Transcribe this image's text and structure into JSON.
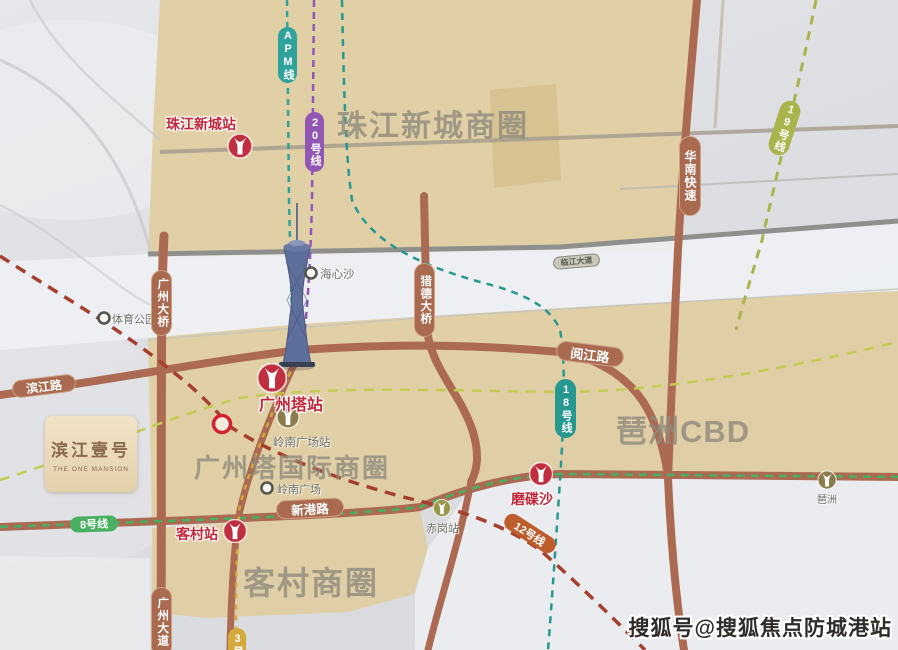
{
  "watermark": "搜狐号@搜狐焦点防城港站",
  "project": {
    "name_cn": "滨江壹号",
    "name_en": "THE ONE MANSION"
  },
  "districts": {
    "zhujiang_new_town": "珠江新城商圈",
    "canton_tower_intl": "广州塔国际商圈",
    "pazhou_cbd": "琶洲CBD",
    "kecun": "客村商圈"
  },
  "metro_lines": {
    "apm": "APM线",
    "line20": "20号线",
    "line19": "19号线",
    "line18": "18号线",
    "line8": "8号线",
    "line12": "12号线",
    "line3": "3号线"
  },
  "roads": {
    "huanan_express": "华南快速",
    "guangzhou_bridge": "广州大桥",
    "liede_bridge": "猎德大桥",
    "linjiang_avenue": "临江大道",
    "binjiang_road": "滨江路",
    "yuejiang_road": "阅江路",
    "xingang_road": "新港路",
    "guangzhou_avenue": "广州大道"
  },
  "stations": {
    "zhujiang_new_town": "珠江新城站",
    "canton_tower": "广州塔站",
    "lingnan_square": "岭南广场站",
    "kecun": "客村站",
    "modiesha": "磨碟沙",
    "chigang": "赤岗站",
    "pazhou": "琶洲"
  },
  "pois": {
    "haixinsha": "海心沙",
    "sports_park": "体育公园",
    "lingnan_square": "岭南广场"
  },
  "colors": {
    "road_terracotta": "#ab6a51",
    "metro_red": "#bf2f40",
    "station_olive": "#8b7c4c",
    "apm_teal": "#2fa29b",
    "line20_purple": "#9257b5",
    "line19_olive": "#a9b54c",
    "line18_teal": "#27988f",
    "line8_green": "#47b061",
    "line12_rust": "#a5402e",
    "line3_yellow": "#d2a93a",
    "district_beige": "#e0cda2",
    "river_gray": "#eef0f4"
  }
}
